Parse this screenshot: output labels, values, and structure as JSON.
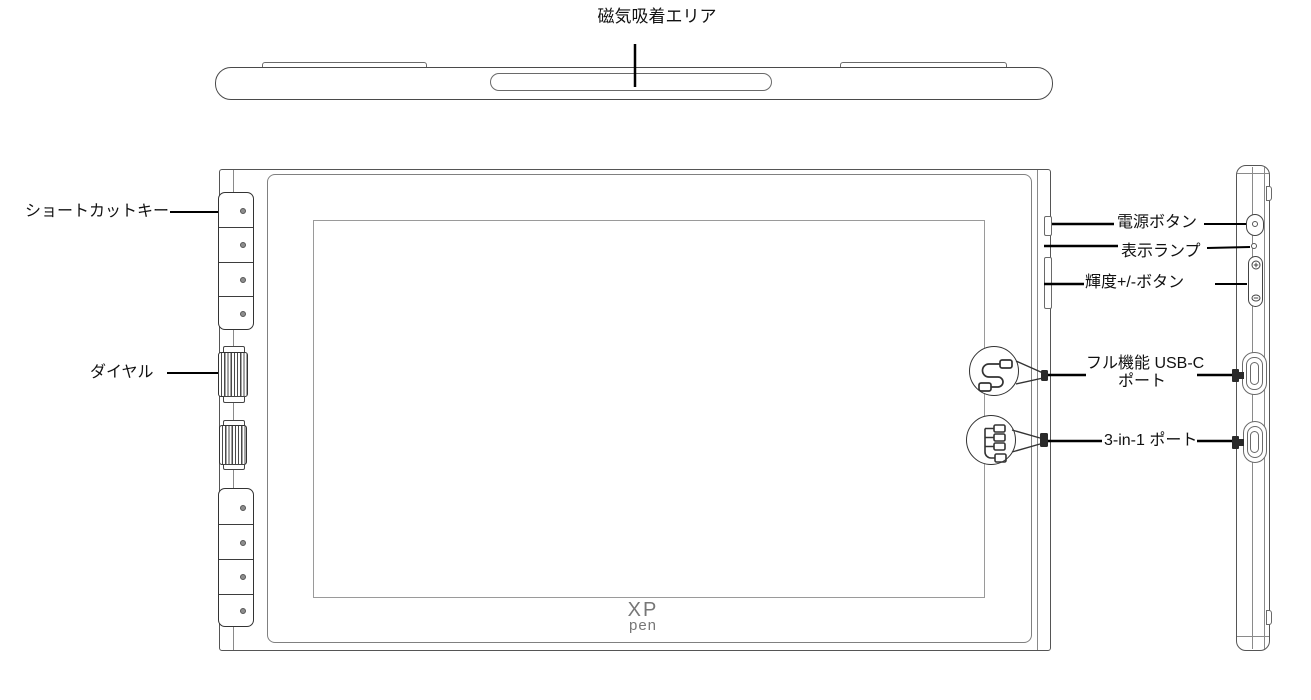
{
  "diagram": {
    "labels": {
      "magnetic_area": "磁気吸着エリア",
      "shortcut_keys": "ショートカットキー",
      "dial": "ダイヤル",
      "power_button": "電源ボタン",
      "indicator_lamp": "表示ランプ",
      "brightness_buttons": "輝度+/-ボタン",
      "usb_c_port_line1": "フル機能 USB-C",
      "usb_c_port_line2": "ポート",
      "three_in_one_port": "3-in-1 ポート"
    },
    "logo": {
      "line1": "XP",
      "line2": "pen"
    },
    "icons": {
      "callout_top_circle": "usb-c-cable",
      "callout_bottom_circle": "3-in-1-cable",
      "brightness_up": "+",
      "brightness_down": "−",
      "power": "circle-with-dot"
    },
    "colors": {
      "outline": "#4a4a4a",
      "frame": "#808080",
      "screen_border": "#9a9a9a",
      "callout_line": "#000000",
      "plug_fill": "#2a2a2a",
      "text": "#111111",
      "background": "#ffffff"
    }
  }
}
